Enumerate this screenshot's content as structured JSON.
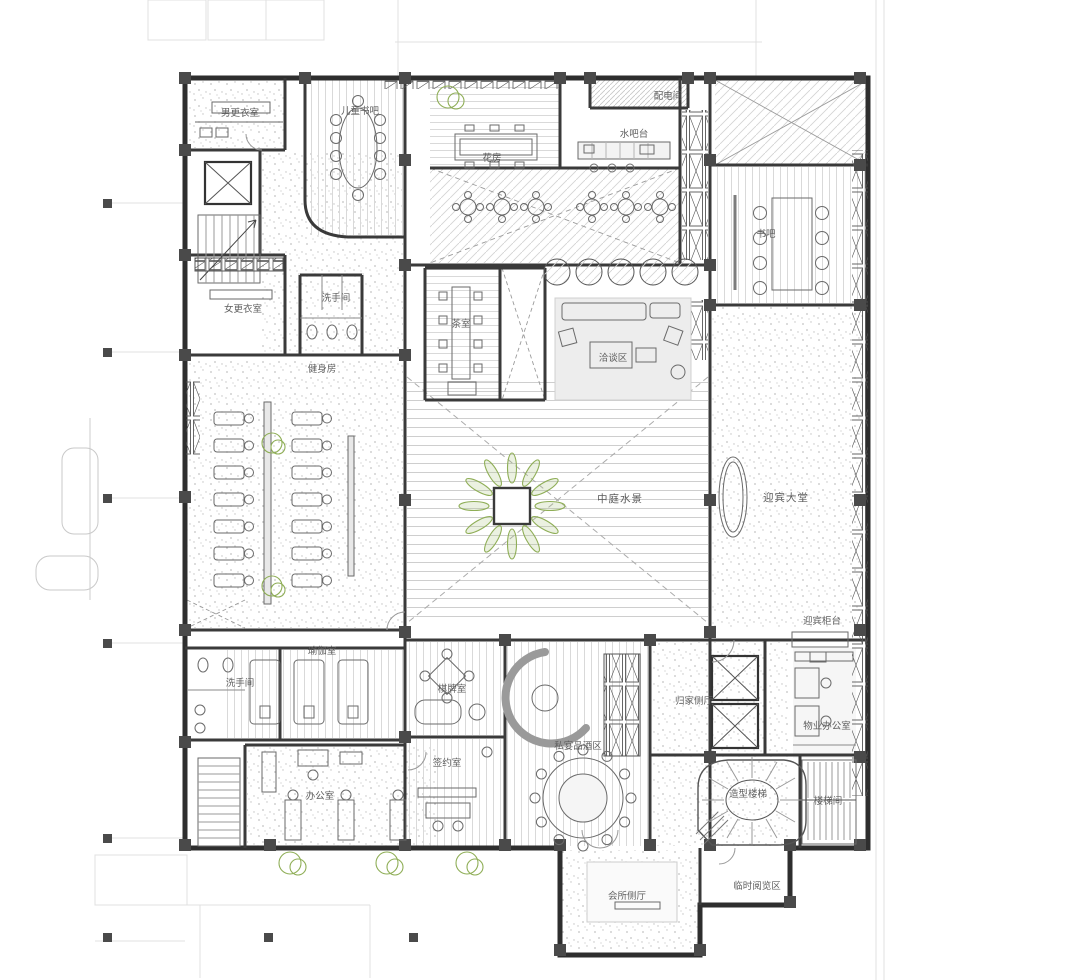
{
  "plan": {
    "type": "architectural-floor-plan",
    "language": "zh-CN",
    "colors": {
      "wall": "#2e2e2e",
      "column": "#4a4a4a",
      "label": "#5f5f5f",
      "vegetation": "#8fae57",
      "floor_hatch": "#d6d6d6"
    }
  },
  "rooms": [
    {
      "id": "mens-locker",
      "label": "男更衣室"
    },
    {
      "id": "kids-book-bar",
      "label": "儿童书吧"
    },
    {
      "id": "flower-house",
      "label": "花房"
    },
    {
      "id": "power-room",
      "label": "配电间"
    },
    {
      "id": "water-bar",
      "label": "水吧台"
    },
    {
      "id": "book-bar",
      "label": "书吧"
    },
    {
      "id": "womens-locker",
      "label": "女更衣室"
    },
    {
      "id": "restroom-upper",
      "label": "洗手间"
    },
    {
      "id": "gym",
      "label": "健身房"
    },
    {
      "id": "tea-room",
      "label": "茶室"
    },
    {
      "id": "lounge",
      "label": "洽谈区"
    },
    {
      "id": "courtyard-water",
      "label": "中庭水景"
    },
    {
      "id": "lobby",
      "label": "迎宾大堂"
    },
    {
      "id": "reception-counter",
      "label": "迎宾柜台"
    },
    {
      "id": "yoga-room",
      "label": "瑜伽室"
    },
    {
      "id": "restroom-lower",
      "label": "洗手间"
    },
    {
      "id": "chess-room",
      "label": "棋牌室"
    },
    {
      "id": "signing-room",
      "label": "签约室"
    },
    {
      "id": "private-dining",
      "label": "私宴品酒区"
    },
    {
      "id": "homecoming-hall",
      "label": "归家侧厅"
    },
    {
      "id": "property-office",
      "label": "物业办公室"
    },
    {
      "id": "office",
      "label": "办公室"
    },
    {
      "id": "sculptural-stair",
      "label": "造型楼梯"
    },
    {
      "id": "stairwell",
      "label": "楼梯间"
    },
    {
      "id": "temp-reading-area",
      "label": "临时阅览区"
    },
    {
      "id": "club-side-hall",
      "label": "会所侧厅"
    }
  ]
}
